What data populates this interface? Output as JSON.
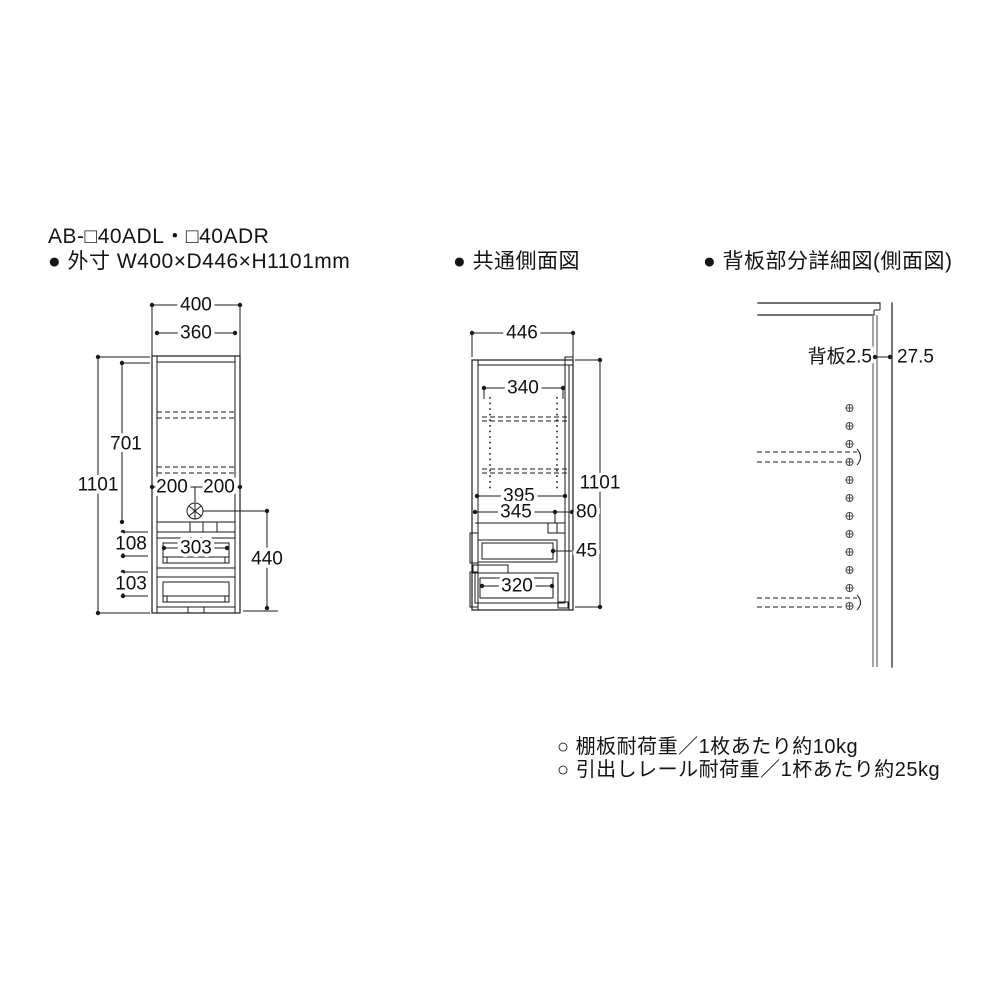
{
  "header": {
    "model": "AB-□40ADL・□40ADR",
    "outer_size": "● 外寸 W400×D446×H1101mm"
  },
  "titles": {
    "side_view": "● 共通側面図",
    "back_detail": "● 背板部分詳細図(側面図)"
  },
  "front_view": {
    "width_outer": "400",
    "width_inner": "360",
    "height_total": "1101",
    "upper_height": "701",
    "left_half": "200",
    "right_half": "200",
    "drawer1_front": "108",
    "drawer2_front": "103",
    "drawer_inner_width": "303",
    "hook_to_floor": "440"
  },
  "side_view": {
    "depth": "446",
    "height_total": "1101",
    "pin_span": "340",
    "inner_depth": "395",
    "rail_depth": "345",
    "back_gap": "80",
    "rail_height": "45",
    "drawer_depth": "320"
  },
  "back_detail": {
    "back_panel_label": "背板2.5",
    "wall_gap": "27.5"
  },
  "notes": {
    "shelf_load": "○ 棚板耐荷重／1枚あたり約10kg",
    "drawer_load": "○ 引出しレール耐荷重／1杯あたり約25kg"
  },
  "colors": {
    "line": "#1a1a1a",
    "back_panel": "#8c8c8c",
    "background": "#ffffff"
  }
}
